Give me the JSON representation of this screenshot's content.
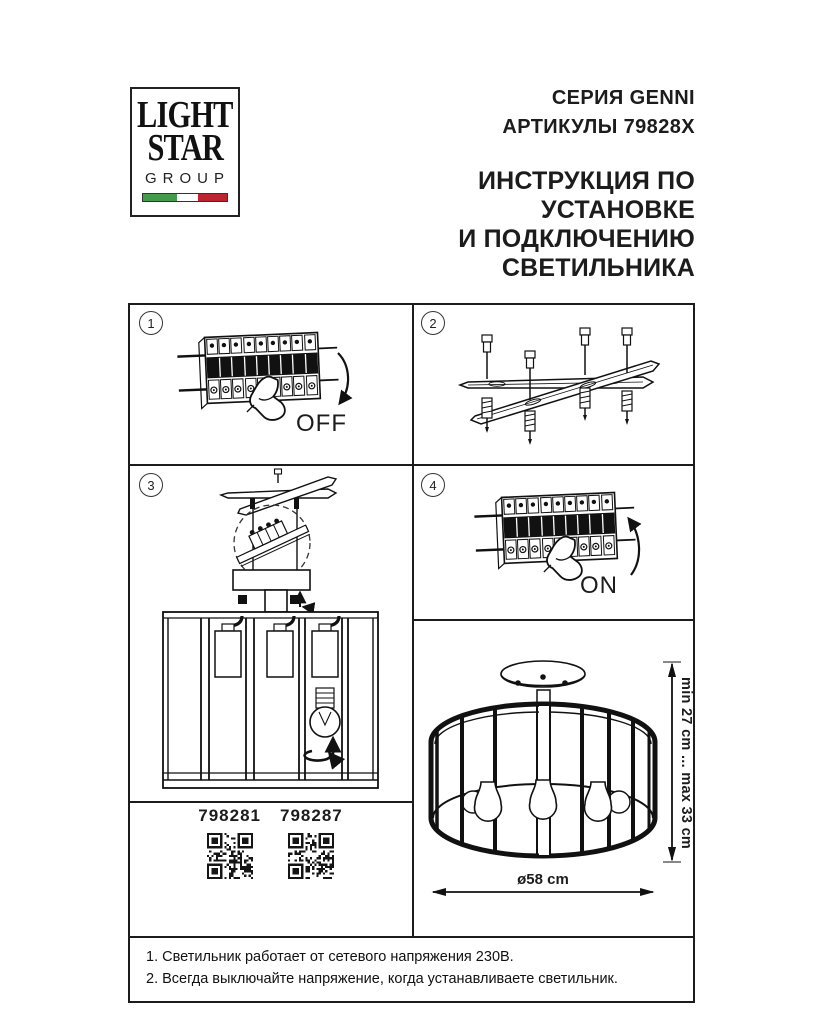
{
  "page": {
    "background": "#ffffff",
    "ink": "#1c1c1c"
  },
  "logo": {
    "word1": "LIGHT",
    "word2": "STAR",
    "word3": "GROUP",
    "flag_green": "#449b4c",
    "flag_white": "#ffffff",
    "flag_red": "#bb2430"
  },
  "header": {
    "series": "СЕРИЯ GENNI",
    "articles": "АРТИКУЛЫ 79828X",
    "title_line1": "ИНСТРУКЦИЯ ПО УСТАНОВКЕ",
    "title_line2": "И ПОДКЛЮЧЕНИЮ СВЕТИЛЬНИКА"
  },
  "steps": {
    "one": {
      "num": "1",
      "label": "OFF"
    },
    "two": {
      "num": "2"
    },
    "three": {
      "num": "3"
    },
    "four": {
      "num": "4",
      "label": "ON"
    }
  },
  "qr": {
    "codes": [
      {
        "value": "798281"
      },
      {
        "value": "798287"
      }
    ]
  },
  "dimensions": {
    "height": "min 27 cm ... max 33 cm",
    "diameter": "ø58 cm"
  },
  "notes": {
    "line1": "1. Светильник работает от сетевого напряжения 230В.",
    "line2": "2. Всегда выключайте напряжение, когда устанавливаете светильник."
  }
}
